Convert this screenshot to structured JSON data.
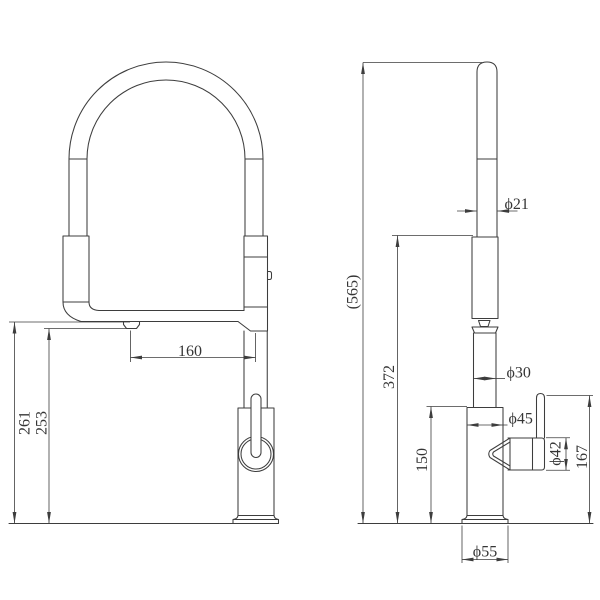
{
  "page": {
    "background": "#ffffff",
    "line_color": "#3d3d3d",
    "text_color": "#353535"
  },
  "front_view": {
    "dims": {
      "spout_reach": "160",
      "spout_height": "261",
      "aerator_clearance_height": "253"
    }
  },
  "side_view": {
    "dims": {
      "overall_height": "(565)",
      "spout_outlet_height": "372",
      "body_height": "150",
      "spring_tube_diameter": "ϕ21",
      "riser_diameter": "ϕ30",
      "body_diameter": "ϕ45",
      "handle_diameter": "ϕ42",
      "handle_height": "167",
      "base_diameter": "ϕ55"
    }
  }
}
